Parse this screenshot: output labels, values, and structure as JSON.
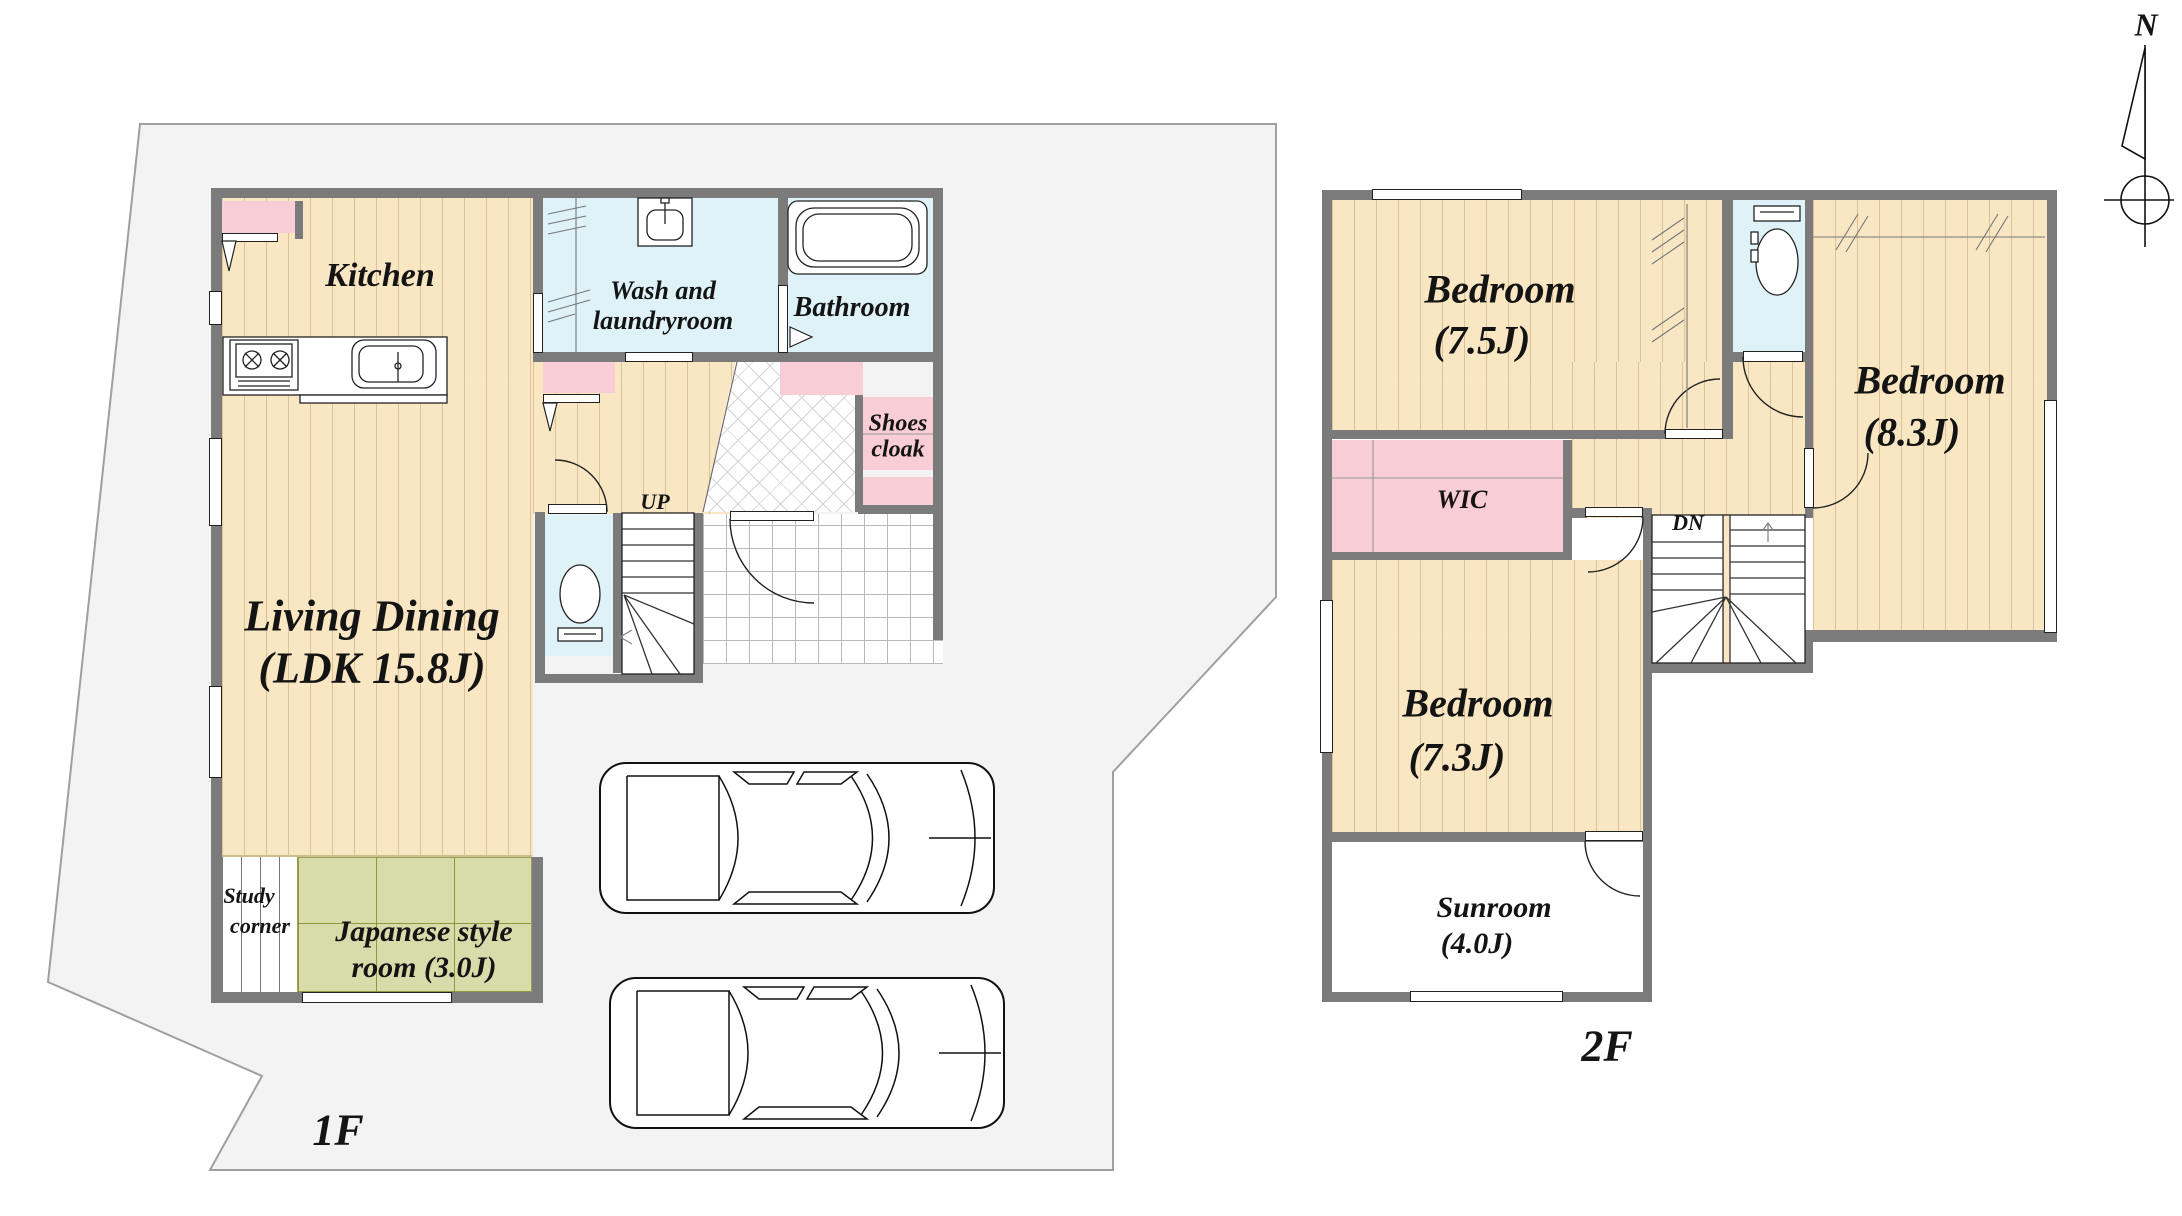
{
  "colors": {
    "wall": "#7b7b7b",
    "floor_wood": "#f9e6c2",
    "tatami": "#d8dcaa",
    "water": "#def2f7",
    "closet_pink": "#f9cdd5",
    "lot": "#f3f3f4"
  },
  "compass": {
    "n": "N"
  },
  "floor1": {
    "label": "1F",
    "kitchen": "Kitchen",
    "wash1": "Wash and",
    "wash2": "laundryroom",
    "bathroom": "Bathroom",
    "shoes1": "Shoes",
    "shoes2": "cloak",
    "living1": "Living Dining",
    "living2": "(LDK 15.8J)",
    "up": "UP",
    "study1": "Study",
    "study2": "corner",
    "japanese1": "Japanese style",
    "japanese2": "room (3.0J)"
  },
  "floor2": {
    "label": "2F",
    "bed75_1": "Bedroom",
    "bed75_2": "(7.5J)",
    "bed83_1": "Bedroom",
    "bed83_2": "(8.3J)",
    "bed73_1": "Bedroom",
    "bed73_2": "(7.3J)",
    "wic": "WIC",
    "dn": "DN",
    "sunroom1": "Sunroom",
    "sunroom2": "(4.0J)"
  }
}
